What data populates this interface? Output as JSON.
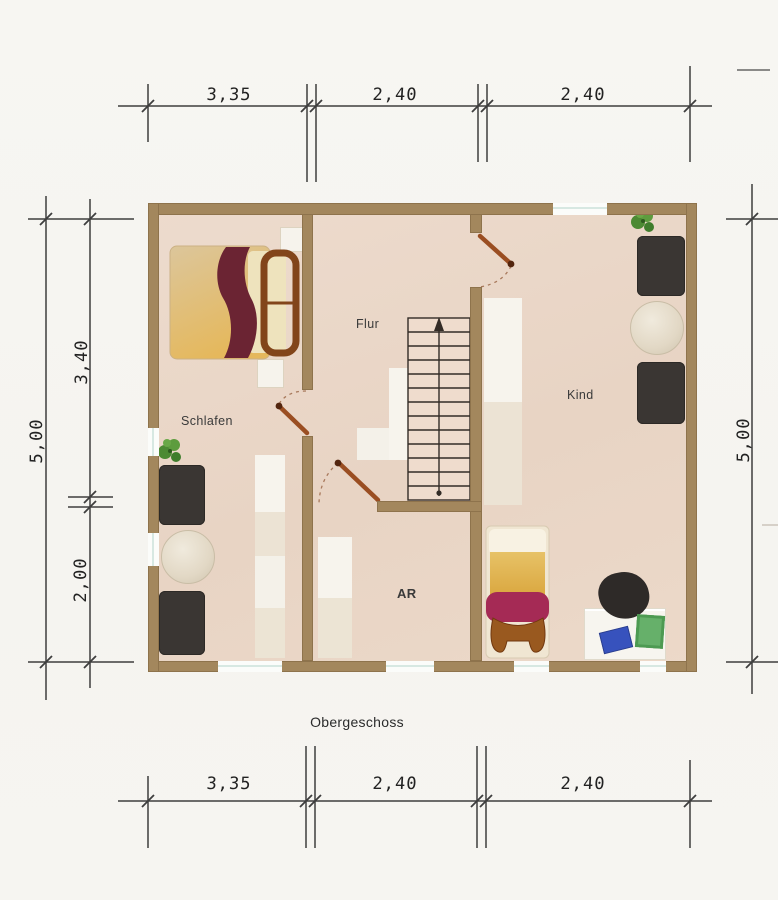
{
  "plan": {
    "floor_title": "Obergeschoss",
    "rooms": {
      "schlafen": "Schlafen",
      "flur": "Flur",
      "kind": "Kind",
      "ar": "AR"
    },
    "dimensions": {
      "top": [
        "3,35",
        "2,40",
        "2,40"
      ],
      "bottom": [
        "3,35",
        "2,40",
        "2,40"
      ],
      "left_total": "5,00",
      "left_upper": "3,40",
      "left_lower": "2,00",
      "right_total": "5,00"
    },
    "stairs": {
      "steps": 13,
      "arrow": "up"
    },
    "furniture": [
      "double-bed",
      "nightstand",
      "nightstand",
      "wardrobe",
      "plant",
      "armchair",
      "side-table",
      "armchair",
      "wardrobe",
      "plant",
      "dresser",
      "round-rug",
      "dresser",
      "single-bed",
      "desk",
      "desk-chair",
      "wardrobe"
    ],
    "colors": {
      "wall": "#a3875d",
      "floor": "#e9d6c7",
      "furniture_dark": "#3a3633",
      "door": "#9a4e22",
      "bed_blanket": "#6b2433",
      "single_bed_band": "#a52a55",
      "paper_blue": "#3752bd",
      "paper_green": "#66b06a",
      "plant": "#4c8a33",
      "line": "#2f2f2f"
    }
  }
}
